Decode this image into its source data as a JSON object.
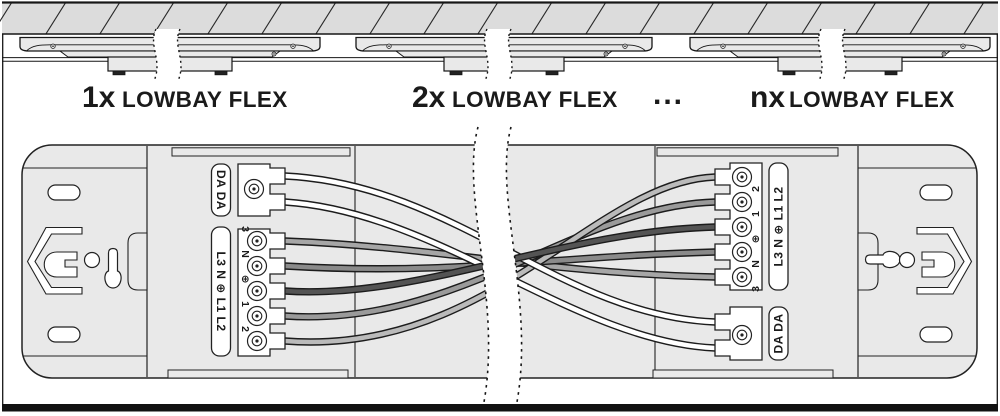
{
  "colors": {
    "wire_outline": "#1c1c1c",
    "fixture_fill": "#e9e9e9",
    "ceiling_fill": "#dcdcdc",
    "wires": {
      "dali_a": "#ffffff",
      "dali_b": "#ffffff",
      "l3": "#a6a6a6",
      "n": "#8a8a8a",
      "pe": "#545454",
      "l1": "#9a9a9a",
      "l2": "#bababa"
    }
  },
  "top_row": {
    "luminaires": [
      {
        "count": "1x",
        "name": "LOWBAY FLEX"
      },
      {
        "count": "2x",
        "name": "LOWBAY FLEX"
      },
      {
        "count": "nx",
        "name": "LOWBAY FLEX"
      }
    ],
    "ellipsis": "..."
  },
  "wiring_view": {
    "left": {
      "dali_label": "DA DA",
      "mains_label": "L3 N ⊕ L1 L2",
      "terminals": [
        "3",
        "N",
        "⊕",
        "1",
        "2"
      ]
    },
    "right": {
      "dali_label": "DA DA",
      "mains_label": "L3 N ⊕ L1 L2",
      "terminals": [
        "2",
        "1",
        "⊕",
        "N",
        "3"
      ]
    }
  }
}
